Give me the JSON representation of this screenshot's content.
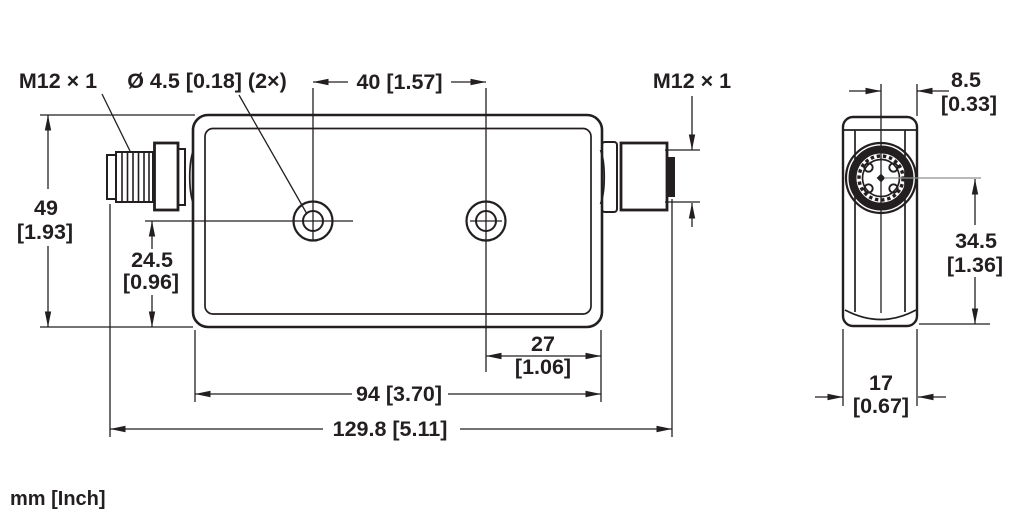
{
  "footer": {
    "units_label": "mm [Inch]"
  },
  "side_view": {
    "left_connector_label": "M12 × 1",
    "hole_callout": "Ø 4.5 [0.18] (2×)",
    "right_connector_label": "M12 × 1",
    "dims": {
      "hole_spacing": "40 [1.57]",
      "height_mm": "49",
      "height_in": "[1.93]",
      "hole_center_mm": "24.5",
      "hole_center_in": "[0.96]",
      "hole_to_end_mm": "27",
      "hole_to_end_in": "[1.06]",
      "body_length": "94 [3.70]",
      "overall_length": "129.8 [5.11]"
    }
  },
  "end_view": {
    "dims": {
      "half_width_mm": "8.5",
      "half_width_in": "[0.33]",
      "connector_center_mm": "34.5",
      "connector_center_in": "[1.36]",
      "width_mm": "17",
      "width_in": "[0.67]"
    }
  },
  "colors": {
    "line": "#231f20",
    "centerline": "#8f8f8f",
    "background": "#ffffff"
  }
}
